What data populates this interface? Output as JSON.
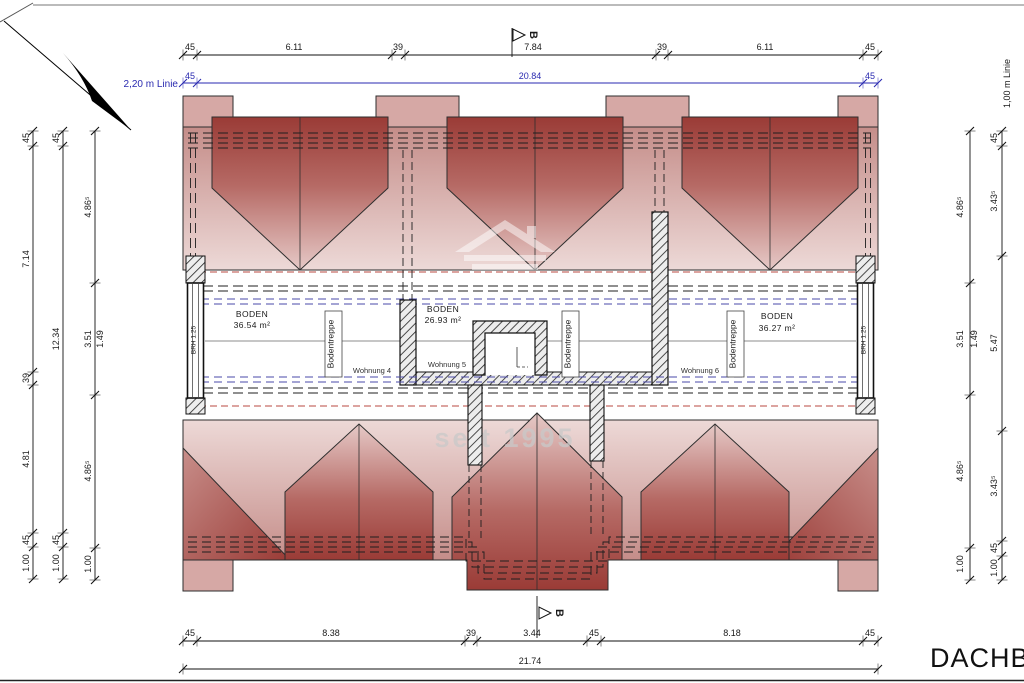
{
  "sheet": {
    "title": "DACHBODEN",
    "watermark": "seit 1995"
  },
  "section": {
    "label": "B"
  },
  "guide_lines": {
    "line220": "2,20 m Linie",
    "line100": "1,00 m Linie"
  },
  "dims": {
    "top": [
      "45",
      "6.11",
      "39",
      "7.84",
      "39",
      "6.11",
      "45"
    ],
    "top_overall": [
      "45",
      "20.84",
      "45"
    ],
    "bottom": [
      "45",
      "8.38",
      "39",
      "3.44",
      "45",
      "8.18",
      "45"
    ],
    "bottom_overall": "21.74",
    "left_outer": [
      "45",
      "7.14",
      "39",
      "4.81",
      "45",
      "1.00"
    ],
    "left_mid": [
      "45",
      "12.34",
      "45",
      "1.00"
    ],
    "left_inner": [
      "4.86⁵",
      "3.51",
      "1.49",
      "4.86⁵",
      "1.00"
    ],
    "right_inner": [
      "4.86⁵",
      "3.51",
      "1.49",
      "4.86⁵",
      "1.00"
    ],
    "right_outer": [
      "45",
      "3.43⁵",
      "5.47",
      "3.43⁵",
      "45",
      "1.00"
    ]
  },
  "rooms": [
    {
      "name": "BODEN",
      "area": "36.54 m²"
    },
    {
      "name": "BODEN",
      "area": "26.93 m²"
    },
    {
      "name": "BODEN",
      "area": "36.27 m²"
    }
  ],
  "labels": {
    "stair": "Bodentreppe",
    "unit4": "Wohnung 4",
    "unit5": "Wohnung 5",
    "unit6": "Wohnung 6",
    "sill": "BRH 1.25"
  },
  "colors": {
    "roof_dark": "#9a3b36",
    "roof_light": "#edd9d7",
    "dim_blue": "#2a2ab0",
    "dash_red": "#b84a42",
    "dash_blue": "#4a4aa8"
  }
}
